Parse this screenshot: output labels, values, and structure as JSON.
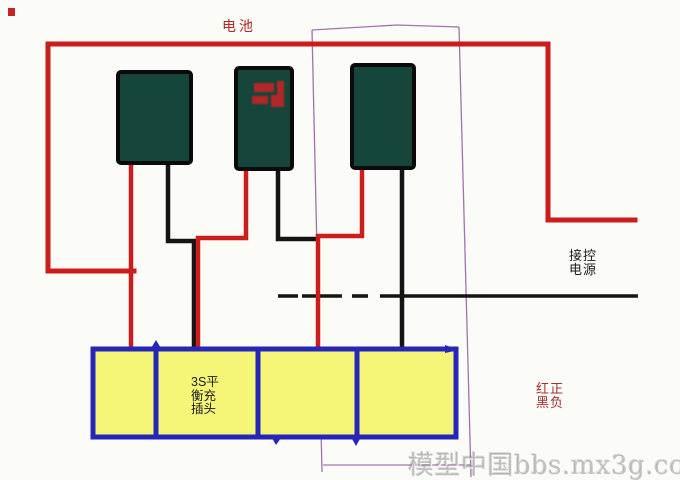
{
  "labels": {
    "battery_bus": "电池",
    "control_power": [
      "接控",
      "电源"
    ],
    "polarity_legend": [
      "红正",
      "黑负"
    ],
    "balance_plug": [
      "3S平",
      "衡充",
      "插头"
    ],
    "balance_plug_full": "3S平衡充插头",
    "watermark": "模型中国bbs.mx3g.com"
  },
  "colors": {
    "wire_red": "#cd1c1c",
    "wire_black": "#141414",
    "battery_fill": "#15453b",
    "battery_border": "#0a0a0a",
    "plug_fill": "#f5f577",
    "plug_border": "#2427ba",
    "selection_box": "#a273a8",
    "label_dark_red": "#a53030",
    "label_black": "#1b1b1b",
    "watermark_gray": "#bcbcbc",
    "background": "#fbfbf8"
  },
  "diagram": {
    "battery_count": 3,
    "plug_cell_count": 4,
    "batteries": [
      {
        "name": "battery-1"
      },
      {
        "name": "battery-2",
        "marking_icon": "red-stamp-marking"
      },
      {
        "name": "battery-3"
      }
    ]
  }
}
